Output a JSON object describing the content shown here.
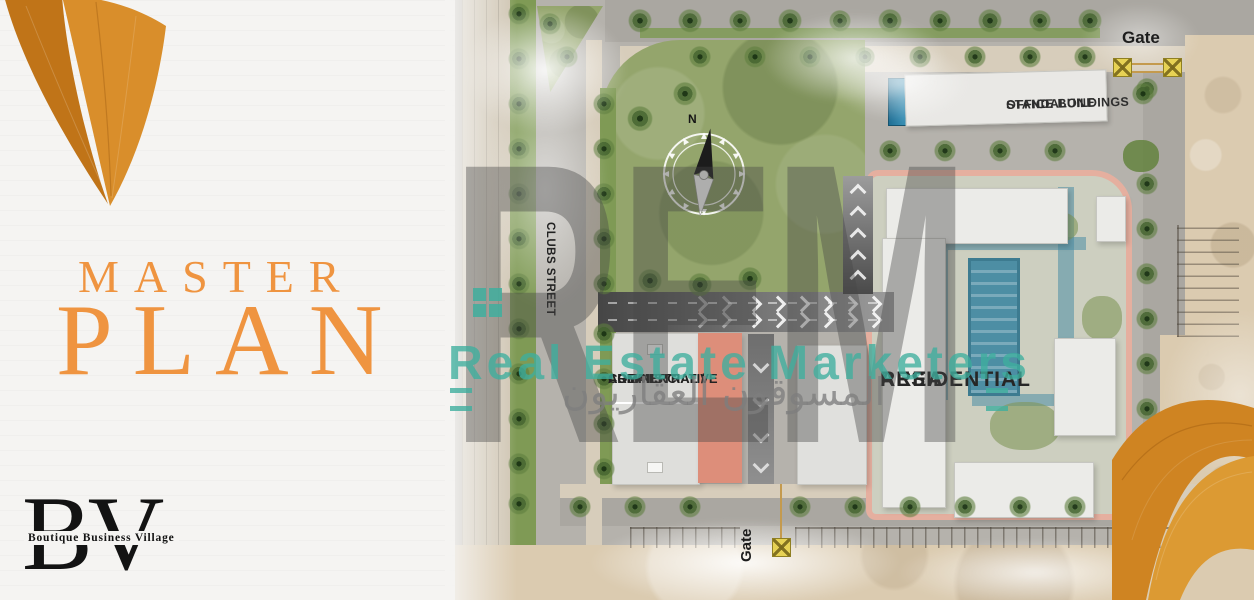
{
  "left_panel": {
    "title_line1": "MASTER",
    "title_line2": "PLAN",
    "logo_monogram": "BV",
    "logo_subtitle": "Boutique Business Village"
  },
  "map_labels": {
    "gate_top": "Gate",
    "gate_bottom": "Gate",
    "standalone_line1": "STANDALONE",
    "standalone_line2": "OFFICE BUILDINGS",
    "clubs_street": "CLUBS STREET",
    "commercial_line1": "COMMERCIAL /",
    "commercial_line2": "ADMINISTRATIVE",
    "commercial_line3": "AREA",
    "residential_line1": "RESIDENTIAL",
    "residential_line2": "AREA",
    "compass_north": "N"
  },
  "watermark": {
    "monogram": "REM",
    "line1": "Real Estate Marketers",
    "line2_arabic": "المسوقون العقاريون"
  },
  "colors": {
    "accent_orange": "#EF9440",
    "leaf_orange": "#D98E2B",
    "watermark_teal": "#3EAF9E",
    "gate_yellow": "#E7D254",
    "salmon_building": "#DD8E7A",
    "residential_outline_pink": "#E7ADA0",
    "pool_blue": "#4D8EA4",
    "park_green": "#94A56C",
    "logo_black": "#131313"
  }
}
